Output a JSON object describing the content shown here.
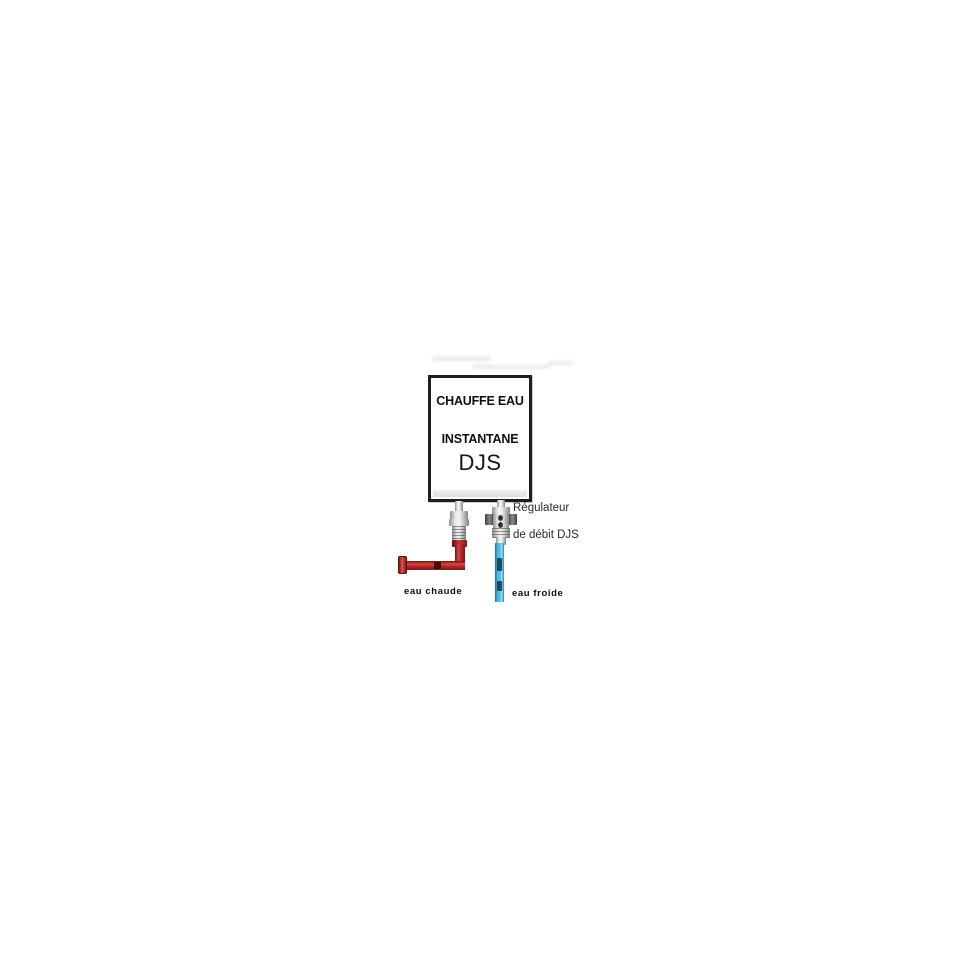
{
  "diagram": {
    "heater": {
      "title_line1": "CHAUFFE EAU",
      "title_line2": "INSTANTANE",
      "model": "DJS"
    },
    "regulator": {
      "label_line1": "Régulateur",
      "label_line2": "de débit DJS"
    },
    "pipes": {
      "hot_label": "eau chaude",
      "cold_label": "eau froide"
    }
  },
  "colors": {
    "hot_water": "#b52525",
    "cold_water": "#45b5e5",
    "outline": "#1e1e1e",
    "metal": "#c2c2c2"
  }
}
